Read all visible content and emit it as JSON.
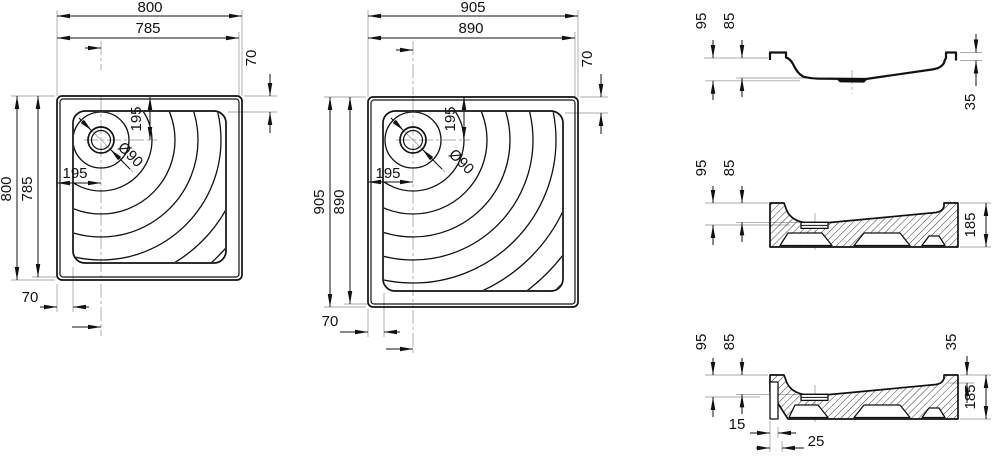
{
  "page": {
    "background": "#ffffff",
    "line_color": "#111111",
    "aux_line_color": "#a9a9a9"
  },
  "tray_small": {
    "outer_width": "800",
    "inner_width": "785",
    "outer_height": "800",
    "inner_height": "785",
    "rim_width_right": "70",
    "rim_width_bottom": "70",
    "drain_offset_top": "195",
    "drain_offset_left": "195",
    "drain_diameter": "Ø90"
  },
  "tray_large": {
    "outer_width": "905",
    "inner_width": "890",
    "outer_height": "905",
    "inner_height": "890",
    "rim_width_right": "70",
    "rim_width_bottom": "70",
    "drain_offset_top": "195",
    "drain_offset_left": "195",
    "drain_diameter": "Ø90"
  },
  "section_acrylic": {
    "height_total": "95",
    "height_inner": "85",
    "edge_height": "35"
  },
  "section_base": {
    "height_total": "95",
    "height_inner": "85",
    "height_overall": "185"
  },
  "section_base_flange": {
    "height_total": "95",
    "height_inner": "85",
    "edge_height": "35",
    "height_overall": "185",
    "flange_offset": "15",
    "flange_width": "25"
  }
}
